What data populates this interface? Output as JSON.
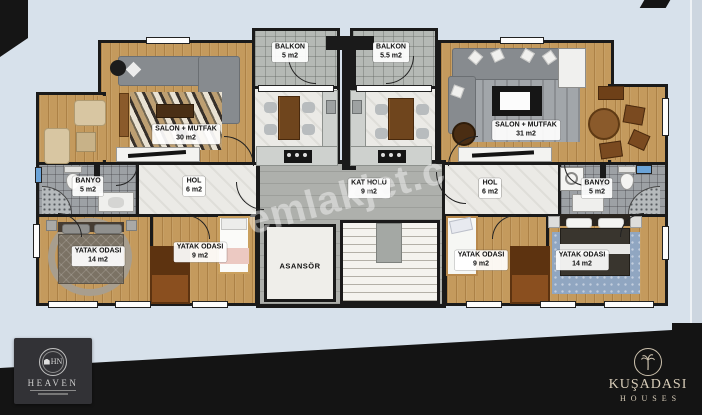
{
  "plan": {
    "rooms": {
      "balkon_left": {
        "name": "BALKON",
        "area": "5 m2"
      },
      "balkon_right": {
        "name": "BALKON",
        "area": "5.5 m2"
      },
      "salon_left": {
        "name": "SALON + MUTFAK",
        "area": "30 m2"
      },
      "salon_right": {
        "name": "SALON + MUTFAK",
        "area": "31 m2"
      },
      "banyo_left": {
        "name": "BANYO",
        "area": "5 m2"
      },
      "banyo_right": {
        "name": "BANYO",
        "area": "5 m2"
      },
      "hol_left": {
        "name": "HOL",
        "area": "6 m2"
      },
      "hol_right": {
        "name": "HOL",
        "area": "6 m2"
      },
      "kat_holu": {
        "name": "KAT HOLÜ",
        "area": "9 m2"
      },
      "asansor": {
        "name": "ASANSÖR",
        "area": ""
      },
      "yatak_left_big": {
        "name": "YATAK ODASI",
        "area": "14 m2"
      },
      "yatak_left_small": {
        "name": "YATAK ODASI",
        "area": "9 m2"
      },
      "yatak_right_small": {
        "name": "YATAK ODASI",
        "area": "9 m2"
      },
      "yatak_right_big": {
        "name": "YATAK ODASI",
        "area": "14 m2"
      }
    }
  },
  "watermark": {
    "text": "emlakjet.c"
  },
  "logos": {
    "heaven": {
      "initials": "HN",
      "name": "HEAVEN"
    },
    "kusadasi": {
      "title": "KUŞADASI",
      "subtitle": "HOUSES"
    }
  },
  "colors": {
    "background": "#d7e1eb",
    "walls": "#1a1a1a",
    "wood_floor": "#c49a5d",
    "balcony_tile": "#b5b9b5",
    "bath_tile": "#9da1a5",
    "core_floor": "#aeb0ac",
    "footer_band": "#141414",
    "logo_text": "#d8cdb9",
    "window_blue": "#6aa3d8"
  }
}
